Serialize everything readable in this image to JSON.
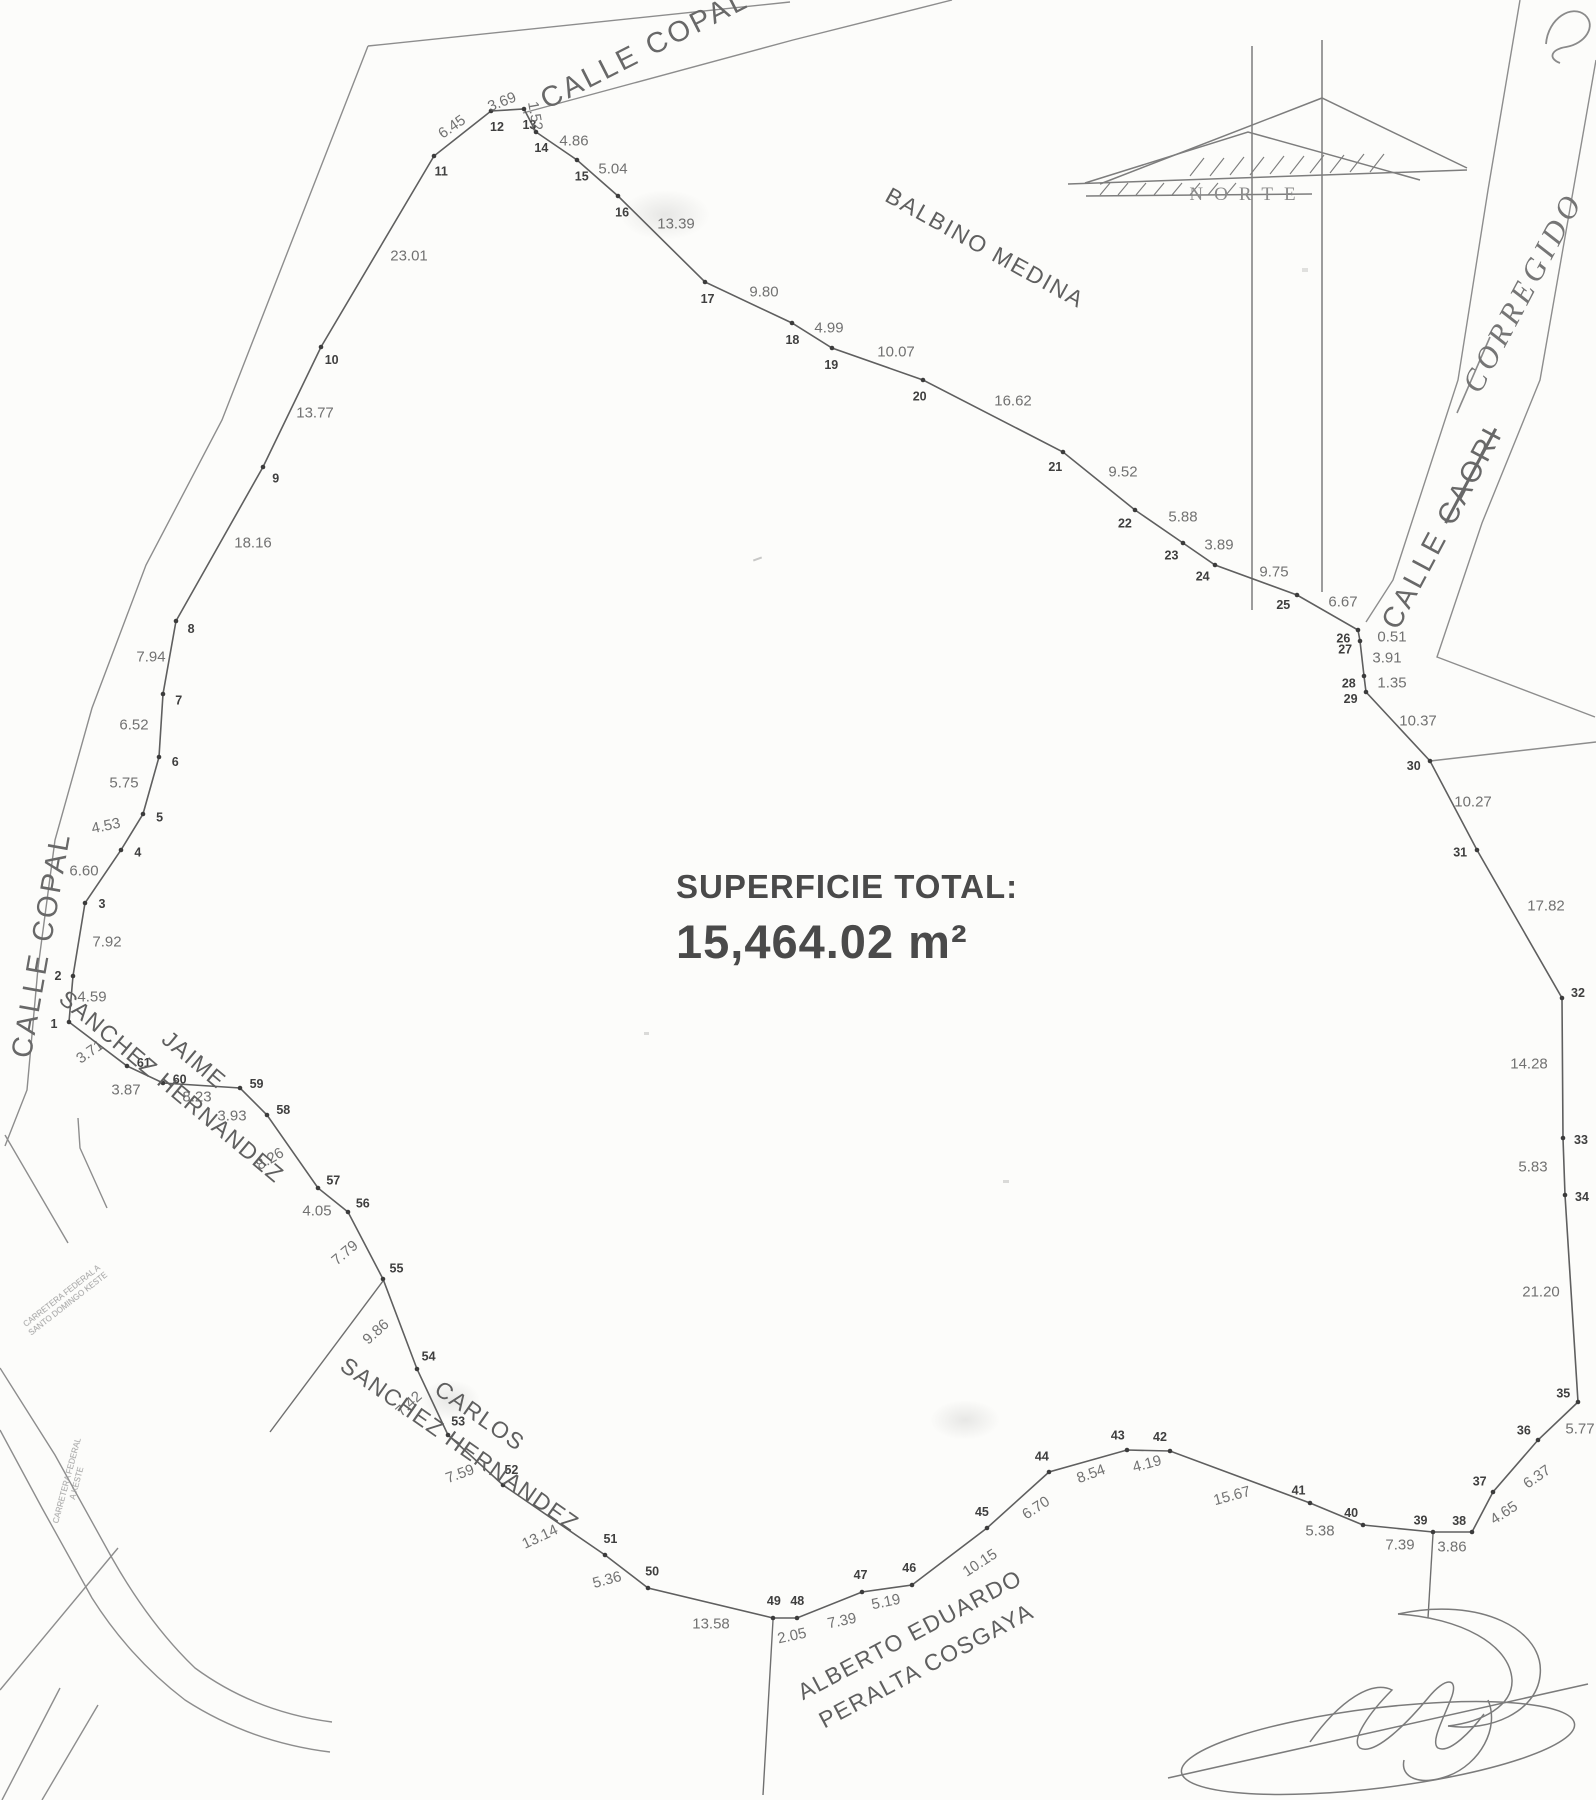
{
  "title": {
    "line1": "SUPERFICIE TOTAL:",
    "line2": "15,464.02 m²"
  },
  "north": {
    "label": "NORTE"
  },
  "annotations": {
    "corregido": "CORREGIDO",
    "streets": {
      "copal_top": "CALLE COPAL",
      "copal_left": "CALLE COPAL",
      "caori_prefix": "CALLE ",
      "caori_struck": "CAORI"
    },
    "neighbors": {
      "balbino": "BALBINO MEDINA",
      "jaime": [
        "JAIME",
        "SANCHEZ HERNANDEZ"
      ],
      "carlos": [
        "CARLOS",
        "SANCHEZ HERNANDEZ"
      ],
      "alberto": [
        "ALBERTO EDUARDO",
        "PERALTA COSGAYA"
      ]
    },
    "road_notes": [
      {
        "lines": [
          "CARRETERA FEDERAL A",
          "SANTO DOMINGO KESTE"
        ]
      },
      {
        "lines": [
          "CARRETERA FEDERAL",
          "A KESTE"
        ]
      }
    ]
  },
  "survey": {
    "vertices": [
      {
        "n": 1,
        "x": 69,
        "y": 1022
      },
      {
        "n": 2,
        "x": 73,
        "y": 976
      },
      {
        "n": 3,
        "x": 85,
        "y": 903
      },
      {
        "n": 4,
        "x": 121,
        "y": 850
      },
      {
        "n": 5,
        "x": 143,
        "y": 814
      },
      {
        "n": 6,
        "x": 159,
        "y": 757
      },
      {
        "n": 7,
        "x": 163,
        "y": 694
      },
      {
        "n": 8,
        "x": 176,
        "y": 621
      },
      {
        "n": 9,
        "x": 263,
        "y": 467
      },
      {
        "n": 10,
        "x": 321,
        "y": 347
      },
      {
        "n": 11,
        "x": 434,
        "y": 156
      },
      {
        "n": 12,
        "x": 491,
        "y": 111
      },
      {
        "n": 13,
        "x": 524,
        "y": 109
      },
      {
        "n": 14,
        "x": 536,
        "y": 132
      },
      {
        "n": 15,
        "x": 577,
        "y": 160
      },
      {
        "n": 16,
        "x": 618,
        "y": 196
      },
      {
        "n": 17,
        "x": 705,
        "y": 282
      },
      {
        "n": 18,
        "x": 792,
        "y": 323
      },
      {
        "n": 19,
        "x": 832,
        "y": 348
      },
      {
        "n": 20,
        "x": 923,
        "y": 380
      },
      {
        "n": 21,
        "x": 1063,
        "y": 452
      },
      {
        "n": 22,
        "x": 1135,
        "y": 510
      },
      {
        "n": 23,
        "x": 1183,
        "y": 543
      },
      {
        "n": 24,
        "x": 1215,
        "y": 565
      },
      {
        "n": 25,
        "x": 1297,
        "y": 595
      },
      {
        "n": 26,
        "x": 1358,
        "y": 630
      },
      {
        "n": 27,
        "x": 1360,
        "y": 641
      },
      {
        "n": 28,
        "x": 1364,
        "y": 676
      },
      {
        "n": 29,
        "x": 1366,
        "y": 692
      },
      {
        "n": 30,
        "x": 1430,
        "y": 761
      },
      {
        "n": 31,
        "x": 1477,
        "y": 850
      },
      {
        "n": 32,
        "x": 1562,
        "y": 998
      },
      {
        "n": 33,
        "x": 1563,
        "y": 1138
      },
      {
        "n": 34,
        "x": 1565,
        "y": 1195
      },
      {
        "n": 35,
        "x": 1578,
        "y": 1402
      },
      {
        "n": 36,
        "x": 1538,
        "y": 1440
      },
      {
        "n": 37,
        "x": 1493,
        "y": 1492
      },
      {
        "n": 38,
        "x": 1472,
        "y": 1532
      },
      {
        "n": 39,
        "x": 1433,
        "y": 1532
      },
      {
        "n": 40,
        "x": 1363,
        "y": 1525
      },
      {
        "n": 41,
        "x": 1310,
        "y": 1503
      },
      {
        "n": 42,
        "x": 1170,
        "y": 1451
      },
      {
        "n": 43,
        "x": 1127,
        "y": 1450
      },
      {
        "n": 44,
        "x": 1049,
        "y": 1472
      },
      {
        "n": 45,
        "x": 987,
        "y": 1528
      },
      {
        "n": 46,
        "x": 912,
        "y": 1585
      },
      {
        "n": 47,
        "x": 862,
        "y": 1592
      },
      {
        "n": 48,
        "x": 797,
        "y": 1618
      },
      {
        "n": 49,
        "x": 773,
        "y": 1618
      },
      {
        "n": 50,
        "x": 648,
        "y": 1588
      },
      {
        "n": 51,
        "x": 605,
        "y": 1555
      },
      {
        "n": 52,
        "x": 503,
        "y": 1485
      },
      {
        "n": 53,
        "x": 448,
        "y": 1435
      },
      {
        "n": 54,
        "x": 417,
        "y": 1369
      },
      {
        "n": 55,
        "x": 383,
        "y": 1279
      },
      {
        "n": 56,
        "x": 348,
        "y": 1212
      },
      {
        "n": 57,
        "x": 318,
        "y": 1188
      },
      {
        "n": 58,
        "x": 267,
        "y": 1115
      },
      {
        "n": 59,
        "x": 240,
        "y": 1088
      },
      {
        "n": 60,
        "x": 163,
        "y": 1083
      },
      {
        "n": 61,
        "x": 127,
        "y": 1066
      }
    ],
    "segments": [
      {
        "a": 1,
        "b": 2,
        "d": "4.59",
        "x": 92,
        "y": 997
      },
      {
        "a": 2,
        "b": 3,
        "d": "7.92",
        "x": 107,
        "y": 942
      },
      {
        "a": 3,
        "b": 4,
        "d": "6.60",
        "x": 84,
        "y": 871
      },
      {
        "a": 4,
        "b": 5,
        "d": "4.53",
        "x": 106,
        "y": 826,
        "r": -12
      },
      {
        "a": 5,
        "b": 6,
        "d": "5.75",
        "x": 124,
        "y": 783
      },
      {
        "a": 6,
        "b": 7,
        "d": "6.52",
        "x": 134,
        "y": 725
      },
      {
        "a": 7,
        "b": 8,
        "d": "7.94",
        "x": 151,
        "y": 657
      },
      {
        "a": 8,
        "b": 9,
        "d": "18.16",
        "x": 253,
        "y": 543
      },
      {
        "a": 9,
        "b": 10,
        "d": "13.77",
        "x": 315,
        "y": 413
      },
      {
        "a": 10,
        "b": 11,
        "d": "23.01",
        "x": 409,
        "y": 256
      },
      {
        "a": 11,
        "b": 12,
        "d": "6.45",
        "x": 452,
        "y": 127,
        "r": -35
      },
      {
        "a": 12,
        "b": 13,
        "d": "3.69",
        "x": 502,
        "y": 102,
        "r": -22
      },
      {
        "a": 13,
        "b": 14,
        "d": "1.52",
        "x": 535,
        "y": 116,
        "r": 80
      },
      {
        "a": 14,
        "b": 15,
        "d": "4.86",
        "x": 574,
        "y": 141
      },
      {
        "a": 15,
        "b": 16,
        "d": "5.04",
        "x": 613,
        "y": 169
      },
      {
        "a": 16,
        "b": 17,
        "d": "13.39",
        "x": 676,
        "y": 224
      },
      {
        "a": 17,
        "b": 18,
        "d": "9.80",
        "x": 764,
        "y": 292
      },
      {
        "a": 18,
        "b": 19,
        "d": "4.99",
        "x": 829,
        "y": 328
      },
      {
        "a": 19,
        "b": 20,
        "d": "10.07",
        "x": 896,
        "y": 352
      },
      {
        "a": 20,
        "b": 21,
        "d": "16.62",
        "x": 1013,
        "y": 401
      },
      {
        "a": 21,
        "b": 22,
        "d": "9.52",
        "x": 1123,
        "y": 472
      },
      {
        "a": 22,
        "b": 23,
        "d": "5.88",
        "x": 1183,
        "y": 517
      },
      {
        "a": 23,
        "b": 24,
        "d": "3.89",
        "x": 1219,
        "y": 545
      },
      {
        "a": 24,
        "b": 25,
        "d": "9.75",
        "x": 1274,
        "y": 572
      },
      {
        "a": 25,
        "b": 26,
        "d": "6.67",
        "x": 1343,
        "y": 602
      },
      {
        "a": 26,
        "b": 27,
        "d": "0.51",
        "x": 1392,
        "y": 637
      },
      {
        "a": 27,
        "b": 28,
        "d": "3.91",
        "x": 1387,
        "y": 658
      },
      {
        "a": 28,
        "b": 29,
        "d": "1.35",
        "x": 1392,
        "y": 683
      },
      {
        "a": 29,
        "b": 30,
        "d": "10.37",
        "x": 1418,
        "y": 721
      },
      {
        "a": 30,
        "b": 31,
        "d": "10.27",
        "x": 1473,
        "y": 802
      },
      {
        "a": 31,
        "b": 32,
        "d": "17.82",
        "x": 1546,
        "y": 906
      },
      {
        "a": 32,
        "b": 33,
        "d": "14.28",
        "x": 1529,
        "y": 1064
      },
      {
        "a": 33,
        "b": 34,
        "d": "5.83",
        "x": 1533,
        "y": 1167
      },
      {
        "a": 34,
        "b": 35,
        "d": "21.20",
        "x": 1541,
        "y": 1292
      },
      {
        "a": 35,
        "b": 36,
        "d": "5.77",
        "x": 1580,
        "y": 1429
      },
      {
        "a": 36,
        "b": 37,
        "d": "6.37",
        "x": 1537,
        "y": 1477,
        "r": -35
      },
      {
        "a": 37,
        "b": 38,
        "d": "4.65",
        "x": 1504,
        "y": 1513,
        "r": -33
      },
      {
        "a": 38,
        "b": 39,
        "d": "3.86",
        "x": 1452,
        "y": 1547
      },
      {
        "a": 39,
        "b": 40,
        "d": "7.39",
        "x": 1400,
        "y": 1545
      },
      {
        "a": 40,
        "b": 41,
        "d": "5.38",
        "x": 1320,
        "y": 1531
      },
      {
        "a": 41,
        "b": 42,
        "d": "15.67",
        "x": 1232,
        "y": 1496,
        "r": -15
      },
      {
        "a": 42,
        "b": 43,
        "d": "4.19",
        "x": 1147,
        "y": 1464,
        "r": -15
      },
      {
        "a": 43,
        "b": 44,
        "d": "8.54",
        "x": 1091,
        "y": 1474,
        "r": -20
      },
      {
        "a": 44,
        "b": 45,
        "d": "6.70",
        "x": 1036,
        "y": 1508,
        "r": -33
      },
      {
        "a": 45,
        "b": 46,
        "d": "10.15",
        "x": 980,
        "y": 1563,
        "r": -33
      },
      {
        "a": 46,
        "b": 47,
        "d": "5.19",
        "x": 886,
        "y": 1602,
        "r": -12
      },
      {
        "a": 47,
        "b": 48,
        "d": "7.39",
        "x": 842,
        "y": 1621,
        "r": -12
      },
      {
        "a": 48,
        "b": 49,
        "d": "2.05",
        "x": 792,
        "y": 1636,
        "r": -12
      },
      {
        "a": 49,
        "b": 50,
        "d": "13.58",
        "x": 711,
        "y": 1624
      },
      {
        "a": 50,
        "b": 51,
        "d": "5.36",
        "x": 607,
        "y": 1580,
        "r": -15
      },
      {
        "a": 51,
        "b": 52,
        "d": "13.14",
        "x": 540,
        "y": 1537,
        "r": -25
      },
      {
        "a": 52,
        "b": 53,
        "d": "7.59",
        "x": 460,
        "y": 1474,
        "r": -20
      },
      {
        "a": 53,
        "b": 54,
        "d": "7.42",
        "x": 409,
        "y": 1404,
        "r": -42
      },
      {
        "a": 54,
        "b": 55,
        "d": "9.86",
        "x": 376,
        "y": 1332,
        "r": -42
      },
      {
        "a": 55,
        "b": 56,
        "d": "7.79",
        "x": 345,
        "y": 1253,
        "r": -40
      },
      {
        "a": 56,
        "b": 57,
        "d": "4.05",
        "x": 317,
        "y": 1211
      },
      {
        "a": 57,
        "b": 58,
        "d": "8.26",
        "x": 270,
        "y": 1159,
        "r": -30
      },
      {
        "a": 58,
        "b": 59,
        "d": "3.93",
        "x": 232,
        "y": 1116
      },
      {
        "a": 59,
        "b": 60,
        "d": "8.23",
        "x": 197,
        "y": 1097
      },
      {
        "a": 60,
        "b": 61,
        "d": "3.87",
        "x": 126,
        "y": 1090
      },
      {
        "a": 61,
        "b": 1,
        "d": "3.71",
        "x": 90,
        "y": 1052,
        "r": -35
      }
    ],
    "label_overrides": {
      "1": [
        -15,
        2
      ],
      "2": [
        -15,
        0
      ],
      "32": [
        16,
        -5
      ],
      "33": [
        18,
        2
      ],
      "34": [
        17,
        2
      ]
    }
  }
}
